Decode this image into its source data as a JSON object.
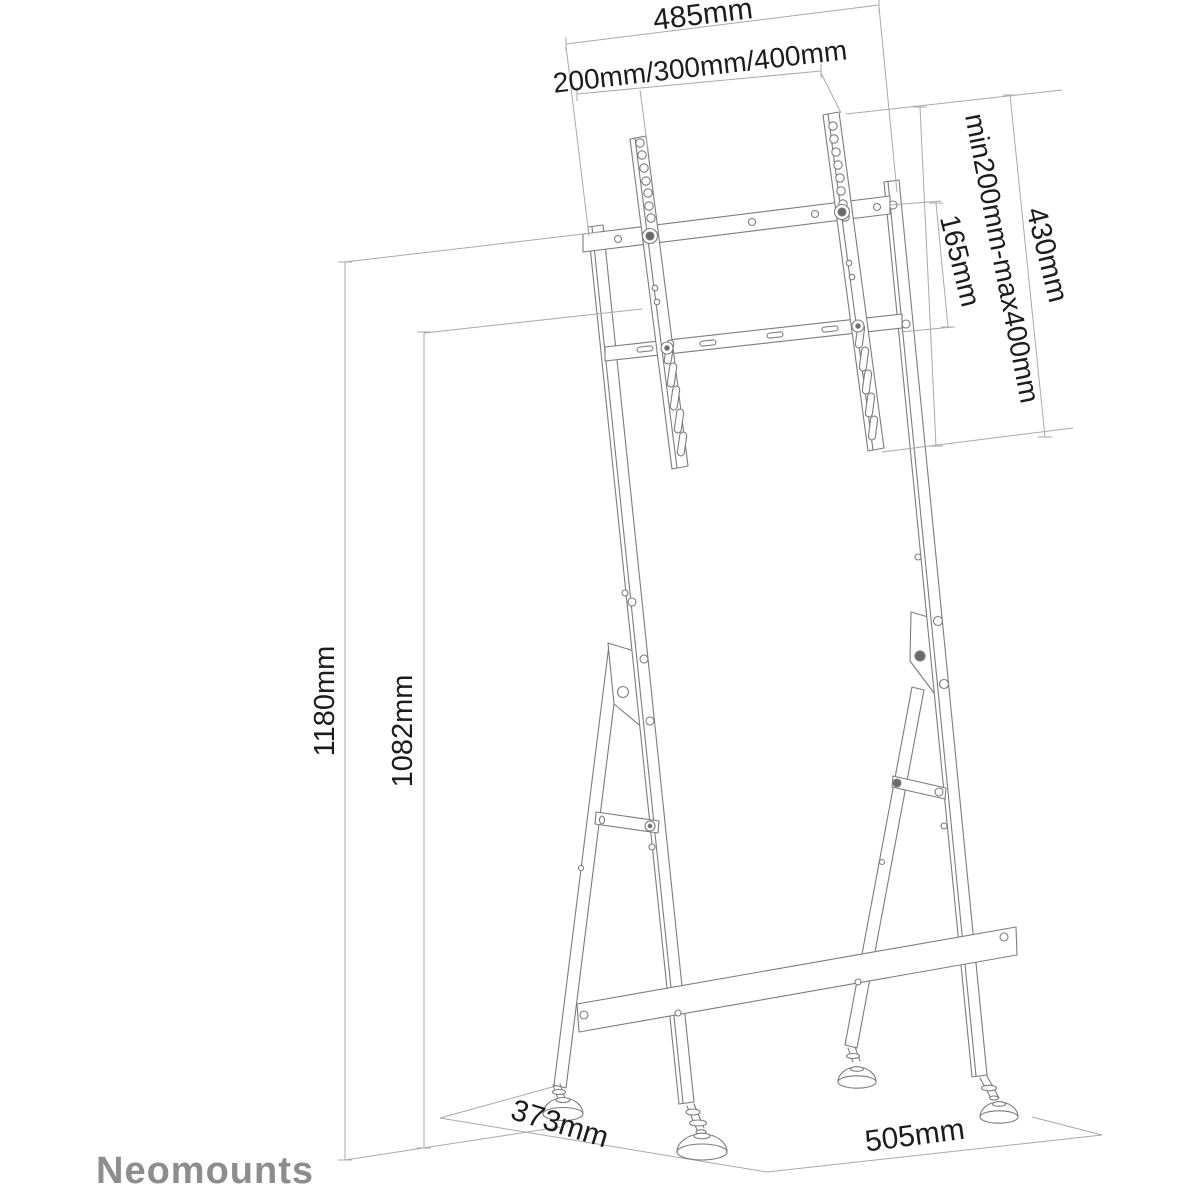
{
  "page": {
    "background_color": "#ffffff"
  },
  "brand": {
    "logo_text": "Neomounts",
    "logo_color": "#8d8d8d"
  },
  "drawing": {
    "subject": "Floor stand for flat screen with VESA mounting rails, A-frame folding legs and four adjustable feet",
    "line_color": "#7c7c7c",
    "dimension_line_color": "#a9a9a9",
    "text_color": "#1c1c1c",
    "dimensions": {
      "top_width": "485mm",
      "vesa_width_options": "200mm/300mm/400mm",
      "vesa_height_range": "min200mm-max400mm",
      "bracket_height": "430mm",
      "crossbar_gap": "165mm",
      "overall_height": "1180mm",
      "frame_height": "1082mm",
      "base_depth": "373mm",
      "base_width": "505mm"
    }
  }
}
